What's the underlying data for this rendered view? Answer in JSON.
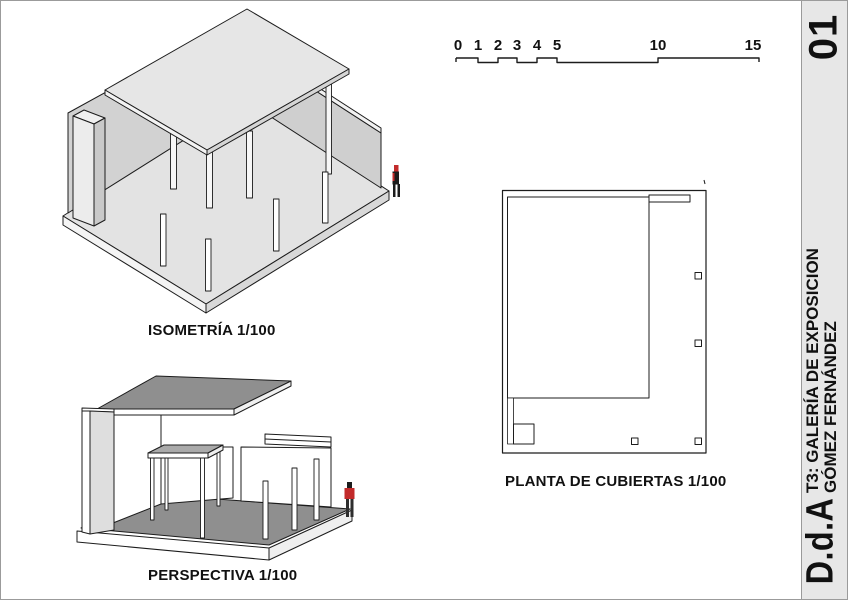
{
  "sidebar": {
    "sheet_number": "01",
    "project_line1": "T3: GALERÍA DE EXPOSICION",
    "project_line2": "GÓMEZ FERNÁNDEZ",
    "logo": "D.d.A"
  },
  "scalebar": {
    "tick_labels": [
      "0",
      "1",
      "2",
      "3",
      "4",
      "5",
      "10",
      "15"
    ]
  },
  "views": {
    "isometric": {
      "label": "ISOMETRÍA 1/100"
    },
    "perspective": {
      "label": "PERSPECTIVA 1/100"
    },
    "roof_plan": {
      "label": "PLANTA DE CUBIERTAS 1/100"
    }
  },
  "colors": {
    "accent_red": "#c22b2b",
    "light_gray_fill": "#e3e3e3",
    "mid_gray_fill": "#d2d2d2",
    "dark_gray_fill": "#8f8f8f",
    "sidebar_bg": "#e7e7e7",
    "border_gray": "#9a9a9a",
    "line_black": "#1c1c1c"
  }
}
